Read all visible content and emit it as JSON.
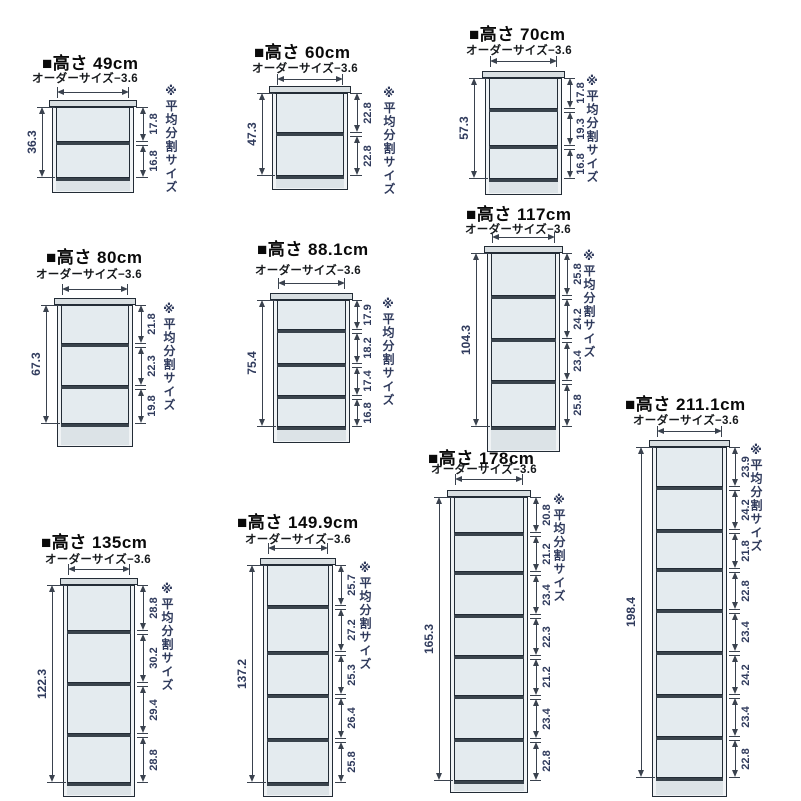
{
  "page": {
    "background": "#ffffff",
    "width": 801,
    "height": 801
  },
  "labels": {
    "order_size": "オーダーサイズ−3.6",
    "equal_split_note": "※平均分割サイズ"
  },
  "colors": {
    "line": "#232c36",
    "dim": "#3a424e",
    "title_text": "#0a0a0a",
    "number_text": "#2f3a5c",
    "interior": "#e4ebef",
    "wall": "#f0f3f5",
    "top_board": "#d8dee1",
    "shelf": "#39434c",
    "base": "#dce3e7"
  },
  "diagrams": [
    {
      "title": "■高さ 49cm",
      "total": "36.3",
      "sections": [
        "17.8",
        "16.8"
      ],
      "geom": {
        "titleX": 42,
        "titleY": 49,
        "orderX": 32,
        "orderY": 70,
        "arrowY": 92,
        "x": 52,
        "y": 100,
        "w": 82,
        "h": 93,
        "baseH": 12,
        "ldimX": 42,
        "rdimX": 143,
        "noteX": 163,
        "noteY": 84
      }
    },
    {
      "title": "■高さ 60cm",
      "total": "47.3",
      "sections": [
        "22.8",
        "22.8"
      ],
      "geom": {
        "titleX": 254,
        "titleY": 38,
        "orderX": 252,
        "orderY": 60,
        "arrowY": 79,
        "x": 272,
        "y": 86,
        "w": 76,
        "h": 104,
        "baseH": 11,
        "ldimX": 262,
        "rdimX": 357,
        "noteX": 381,
        "noteY": 86
      }
    },
    {
      "title": "■高さ 70cm",
      "total": "57.3",
      "sections": [
        "17.8",
        "19.3",
        "16.8"
      ],
      "geom": {
        "titleX": 469,
        "titleY": 20,
        "orderX": 466,
        "orderY": 42,
        "arrowY": 61,
        "x": 485,
        "y": 71,
        "w": 77,
        "h": 124,
        "baseH": 13,
        "ldimX": 474,
        "rdimX": 570,
        "noteX": 584,
        "noteY": 74
      }
    },
    {
      "title": "■高さ 80cm",
      "total": "67.3",
      "sections": [
        "21.8",
        "22.3",
        "19.8"
      ],
      "geom": {
        "titleX": 46,
        "titleY": 243,
        "orderX": 36,
        "orderY": 266,
        "arrowY": 289,
        "x": 57,
        "y": 298,
        "w": 76,
        "h": 149,
        "baseH": 20,
        "ldimX": 46,
        "rdimX": 141,
        "noteX": 161,
        "noteY": 302
      }
    },
    {
      "title": "■高さ 88.1cm",
      "total": "75.4",
      "sections": [
        "17.9",
        "18.2",
        "17.4",
        "16.8"
      ],
      "geom": {
        "titleX": 257,
        "titleY": 235,
        "orderX": 255,
        "orderY": 262,
        "arrowY": 283,
        "x": 273,
        "y": 293,
        "w": 77,
        "h": 150,
        "baseH": 13,
        "ldimX": 262,
        "rdimX": 357,
        "noteX": 380,
        "noteY": 297
      }
    },
    {
      "title": "■高さ 117cm",
      "total": "104.3",
      "sections": [
        "25.8",
        "24.2",
        "23.4",
        "25.8"
      ],
      "geom": {
        "titleX": 466,
        "titleY": 200,
        "orderX": 465,
        "orderY": 221,
        "arrowY": 237,
        "x": 487,
        "y": 246,
        "w": 73,
        "h": 206,
        "baseH": 22,
        "ldimX": 476,
        "rdimX": 567,
        "noteX": 581,
        "noteY": 249
      }
    },
    {
      "title": "■高さ 135cm",
      "total": "122.3",
      "sections": [
        "28.8",
        "30.2",
        "29.4",
        "28.8"
      ],
      "geom": {
        "titleX": 41,
        "titleY": 528,
        "orderX": 45,
        "orderY": 551,
        "arrowY": 569,
        "x": 63,
        "y": 578,
        "w": 72,
        "h": 219,
        "baseH": 11,
        "ldimX": 52,
        "rdimX": 143,
        "noteX": 159,
        "noteY": 582
      }
    },
    {
      "title": "■高さ 149.9cm",
      "total": "137.2",
      "sections": [
        "25.7",
        "27.2",
        "25.3",
        "26.4",
        "25.8"
      ],
      "geom": {
        "titleX": 237,
        "titleY": 508,
        "orderX": 245,
        "orderY": 531,
        "arrowY": 548,
        "x": 263,
        "y": 558,
        "w": 70,
        "h": 239,
        "baseH": 11,
        "ldimX": 252,
        "rdimX": 341,
        "noteX": 357,
        "noteY": 561
      }
    },
    {
      "title": "■高さ 178cm",
      "total": "165.3",
      "sections": [
        "20.8",
        "21.2",
        "23.4",
        "22.3",
        "21.2",
        "23.4",
        "22.8"
      ],
      "geom": {
        "titleX": 428,
        "titleY": 444,
        "orderX": 431,
        "orderY": 461,
        "arrowY": 479,
        "x": 450,
        "y": 490,
        "w": 78,
        "h": 303,
        "baseH": 9,
        "ldimX": 439,
        "rdimX": 536,
        "noteX": 551,
        "noteY": 493
      }
    },
    {
      "title": "■高さ 211.1cm",
      "total": "198.4",
      "sections": [
        "23.9",
        "24.2",
        "21.8",
        "22.8",
        "23.4",
        "24.2",
        "23.4",
        "22.8"
      ],
      "geom": {
        "titleX": 625,
        "titleY": 390,
        "orderX": 633,
        "orderY": 412,
        "arrowY": 431,
        "x": 652,
        "y": 440,
        "w": 75,
        "h": 357,
        "baseH": 16,
        "ldimX": 641,
        "rdimX": 735,
        "noteX": 748,
        "noteY": 443
      }
    }
  ]
}
